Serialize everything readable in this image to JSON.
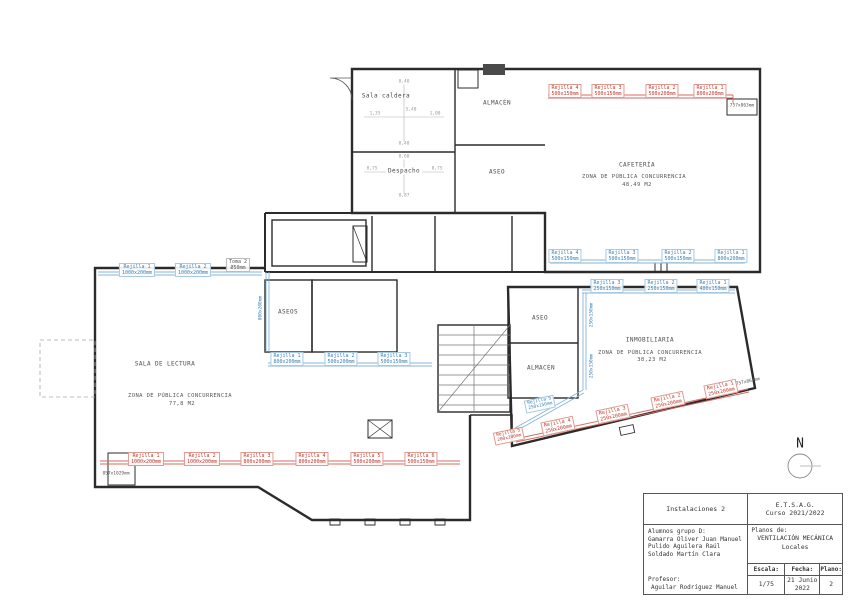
{
  "plan": {
    "north_label": "N",
    "rooms": {
      "sala_caldera": "Sala caldera",
      "despacho": "Despacho",
      "almacen_top": "ALMACÉN",
      "aseo_top": "ASEO",
      "aseos": "ASEOS",
      "aseo_mid": "ASEO",
      "almacen_mid": "ALMACÉN",
      "cafeteria": {
        "name": "CAFETERÍA",
        "zone": "ZONA DE PÚBLICA CONCURRENCIA",
        "area": "48,49 M2"
      },
      "sala_lectura": {
        "name": "SALA DE LECTURA",
        "zone": "ZONA DE PÚBLICA CONCURRENCIA",
        "area": "77,8 M2"
      },
      "inmobiliaria": {
        "name": "INMOBILIARIA",
        "zone": "ZONA DE PÚBLICA CONCURRENCIA",
        "area": "38,23 M2"
      }
    },
    "grilles": {
      "caf_sup": [
        {
          "n": "Rejilla 4",
          "s": "500x150mm"
        },
        {
          "n": "Rejilla 3",
          "s": "500x150mm"
        },
        {
          "n": "Rejilla 2",
          "s": "500x200mm"
        },
        {
          "n": "Rejilla 1",
          "s": "800x200mm"
        }
      ],
      "caf_ret": [
        {
          "n": "Rejilla 4",
          "s": "500x150mm"
        },
        {
          "n": "Rejilla 3",
          "s": "500x150mm"
        },
        {
          "n": "Rejilla 2",
          "s": "500x150mm"
        },
        {
          "n": "Rejilla 1",
          "s": "800x200mm"
        }
      ],
      "lec_ret": [
        {
          "n": "Rejilla 1",
          "s": "1000x200mm"
        },
        {
          "n": "Rejilla 2",
          "s": "1000x200mm"
        }
      ],
      "lec_sup": [
        {
          "n": "Rejilla 1",
          "s": "1000x200mm"
        },
        {
          "n": "Rejilla 2",
          "s": "1000x200mm"
        },
        {
          "n": "Rejilla 3",
          "s": "800x200mm"
        },
        {
          "n": "Rejilla 4",
          "s": "800x200mm"
        },
        {
          "n": "Rejilla 5",
          "s": "500x200mm"
        },
        {
          "n": "Rejilla 6",
          "s": "500x150mm"
        }
      ],
      "aseos_ret": [
        {
          "n": "Rejilla 1",
          "s": "800x200mm"
        },
        {
          "n": "Rejilla 2",
          "s": "500x200mm"
        },
        {
          "n": "Rejilla 3",
          "s": "500x150mm"
        }
      ],
      "inm_ret": [
        {
          "n": "Rejilla 3",
          "s": "250x150mm"
        },
        {
          "n": "Rejilla 2",
          "s": "250x150mm"
        },
        {
          "n": "Rejilla 1",
          "s": "400x150mm"
        }
      ],
      "inm_sup": [
        {
          "n": "Rejilla 4",
          "s": "250x200mm"
        },
        {
          "n": "Rejilla 3",
          "s": "250x200mm"
        },
        {
          "n": "Rejilla 2",
          "s": "250x200mm"
        },
        {
          "n": "Rejilla 1",
          "s": "250x200mm"
        }
      ],
      "inm_sup_end": {
        "n": "Rejilla 5",
        "s": "200x200mm"
      },
      "inm_ret_diag": {
        "n": "Rejilla 5",
        "s": "250x150mm"
      }
    },
    "notes": {
      "toma_n": "Toma 2",
      "toma_s": "Ø50mm",
      "shaft_left": "857x1029mm",
      "shaft_right_top": "757x863mm",
      "shaft_right_diag": "757x863mm",
      "vert_aseos": "800x200mm",
      "vert_inm_1": "250x150mm",
      "vert_inm_2": "250x150mm"
    },
    "dims": {
      "c_top": "0,40",
      "c_mid": "5,40",
      "c_left": "1,35",
      "c_right": "1,00",
      "c_bottom": "0,40",
      "d_top": "0,60",
      "d_left": "0,75",
      "d_right": "0,75",
      "d_bottom": "0,87"
    }
  },
  "titleblock": {
    "subject": "Instalaciones 2",
    "school": "E.T.S.A.G.",
    "course": "Curso 2021/2022",
    "students_label": "Alumnos grupo D:",
    "students": [
      "Gamarra Oliver Juan Manuel",
      "Pulido Aguilera Raúl",
      "Soldado Martín Clara"
    ],
    "professor_label": "Profesor:",
    "professor": "Aguilar Rodríguez Manuel",
    "plans_label": "Planos de:",
    "plans_title": "VENTILACIÓN MECÁNICA",
    "plans_subtitle": "Locales",
    "scale_label": "Escala:",
    "scale_value": "1/75",
    "date_label": "Fecha:",
    "date_value_1": "21 Junio",
    "date_value_2": "2022",
    "plano_label": "Plano:",
    "plano_value": "2"
  }
}
